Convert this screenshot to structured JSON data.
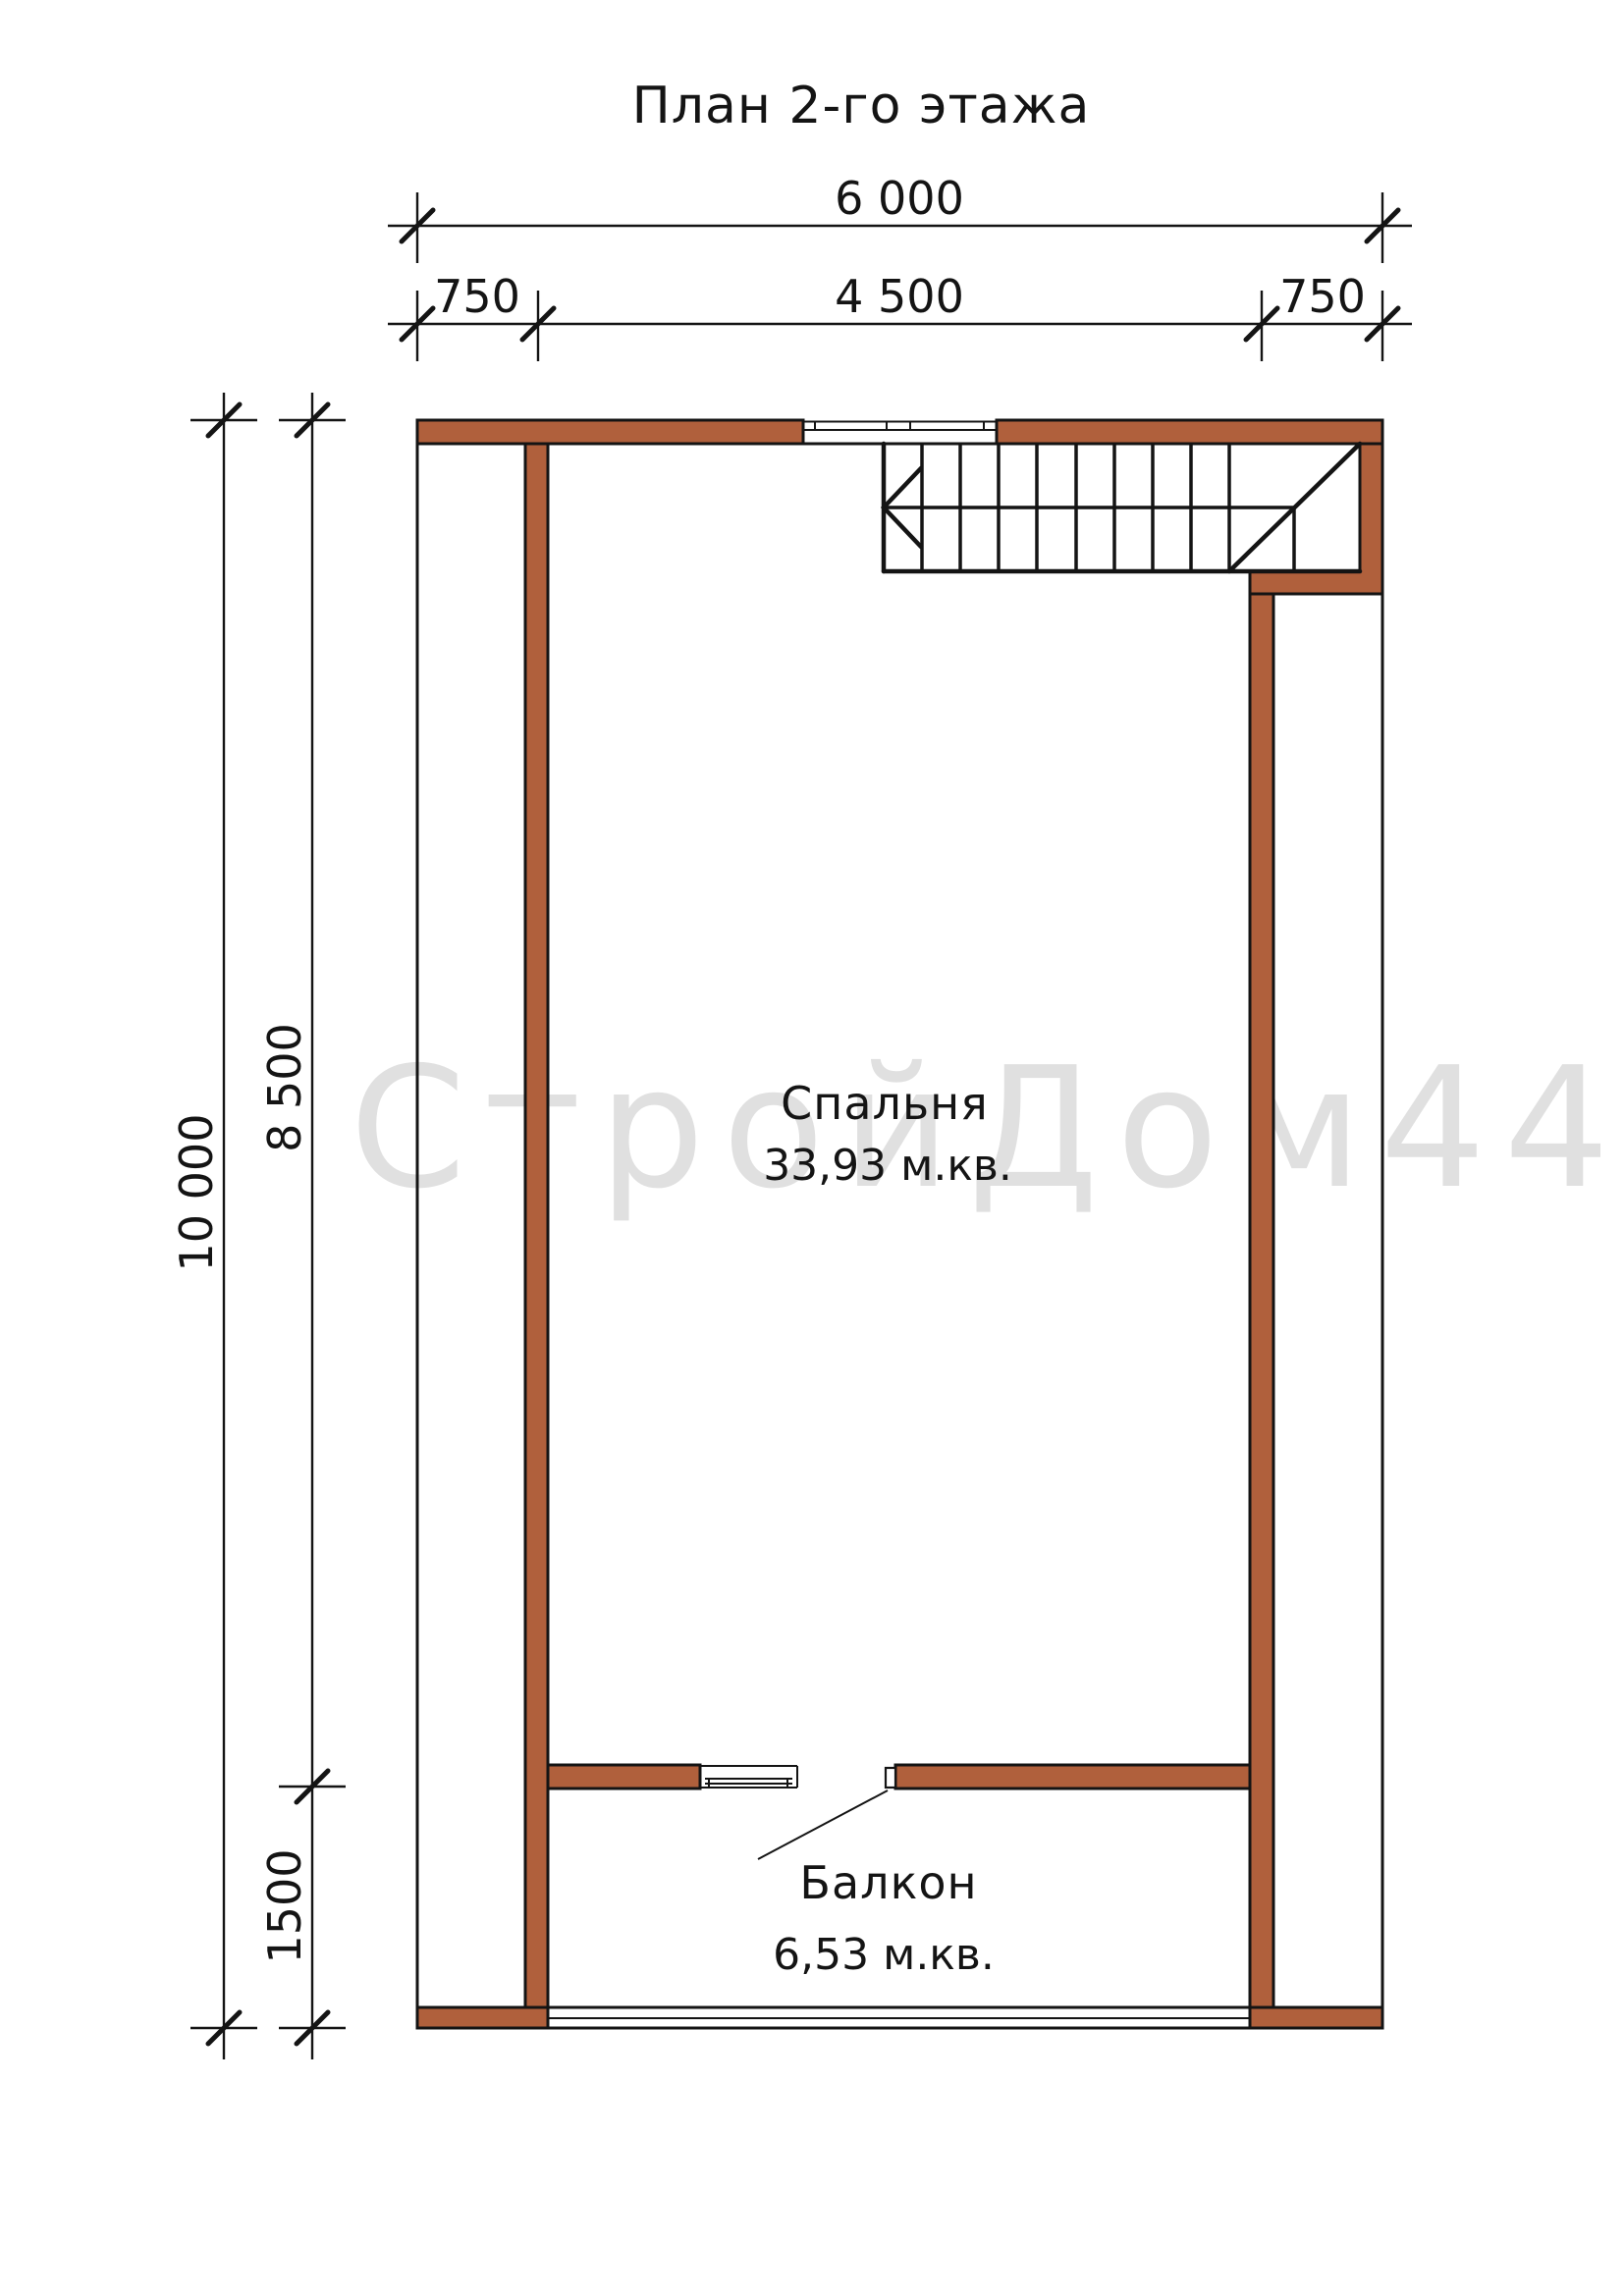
{
  "title": "План 2-го этажа",
  "watermark": "СтройДом44",
  "colors": {
    "wall": "#b0603c",
    "line": "#141414",
    "watermark": "#e0e0e0",
    "background": "#ffffff"
  },
  "rooms": {
    "bedroom": {
      "name": "Спальня",
      "area": "33,93 м.кв."
    },
    "balcony": {
      "name": "Балкон",
      "area": "6,53 м.кв."
    }
  },
  "dimensions": {
    "width_total": "6 000",
    "width_segments": [
      "750",
      "4 500",
      "750"
    ],
    "height_total": "10 000",
    "height_upper": "8 500",
    "height_lower": "1500"
  }
}
